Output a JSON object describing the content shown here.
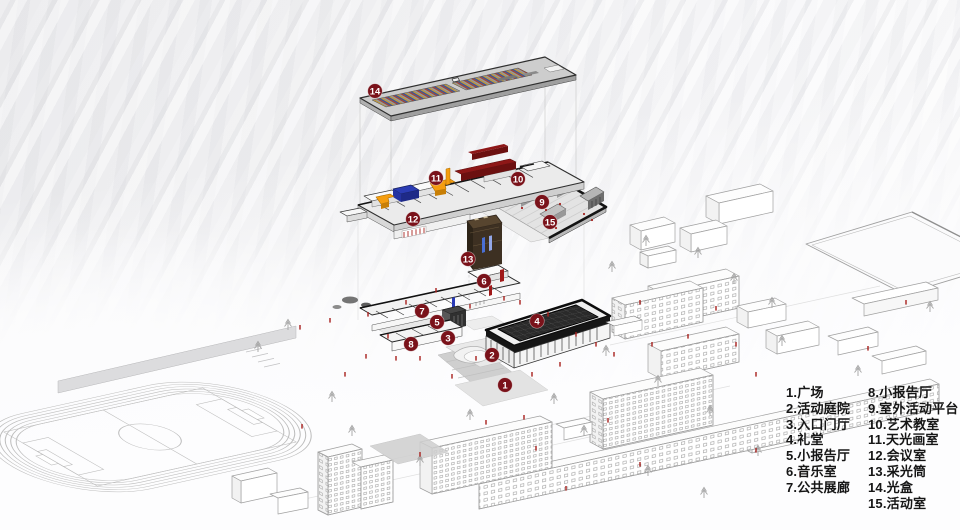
{
  "legend": {
    "columns": [
      {
        "items": [
          "1.广场",
          "2.活动庭院",
          "3.入口门厅",
          "4.礼堂",
          "5.小报告厅",
          "6.音乐室",
          "7.公共展廊"
        ]
      },
      {
        "items": [
          "8.小报告厅",
          "9.室外活动平台",
          "10.艺术教室",
          "11.天光画室",
          "12.会议室",
          "13.采光筒",
          "14.光盒",
          "15.活动室"
        ]
      }
    ]
  },
  "markers": [
    {
      "n": "1",
      "x": 505,
      "y": 385
    },
    {
      "n": "2",
      "x": 492,
      "y": 355
    },
    {
      "n": "3",
      "x": 448,
      "y": 338
    },
    {
      "n": "4",
      "x": 537,
      "y": 321
    },
    {
      "n": "5",
      "x": 437,
      "y": 322
    },
    {
      "n": "6",
      "x": 484,
      "y": 281
    },
    {
      "n": "7",
      "x": 422,
      "y": 311
    },
    {
      "n": "8",
      "x": 411,
      "y": 344
    },
    {
      "n": "9",
      "x": 542,
      "y": 202
    },
    {
      "n": "10",
      "x": 518,
      "y": 179
    },
    {
      "n": "11",
      "x": 436,
      "y": 178
    },
    {
      "n": "12",
      "x": 413,
      "y": 219
    },
    {
      "n": "13",
      "x": 468,
      "y": 259
    },
    {
      "n": "14",
      "x": 375,
      "y": 91
    },
    {
      "n": "15",
      "x": 550,
      "y": 222
    }
  ],
  "colors": {
    "marker_bg": "#7a121a",
    "marker_text": "#ffffff",
    "accent_red": "#8e1717",
    "accent_orange": "#f59d0e",
    "accent_blue": "#2b3cb4",
    "auditorium_black": "#242424",
    "people_red": "#a8201d",
    "line_gray": "#a2a2a2"
  }
}
